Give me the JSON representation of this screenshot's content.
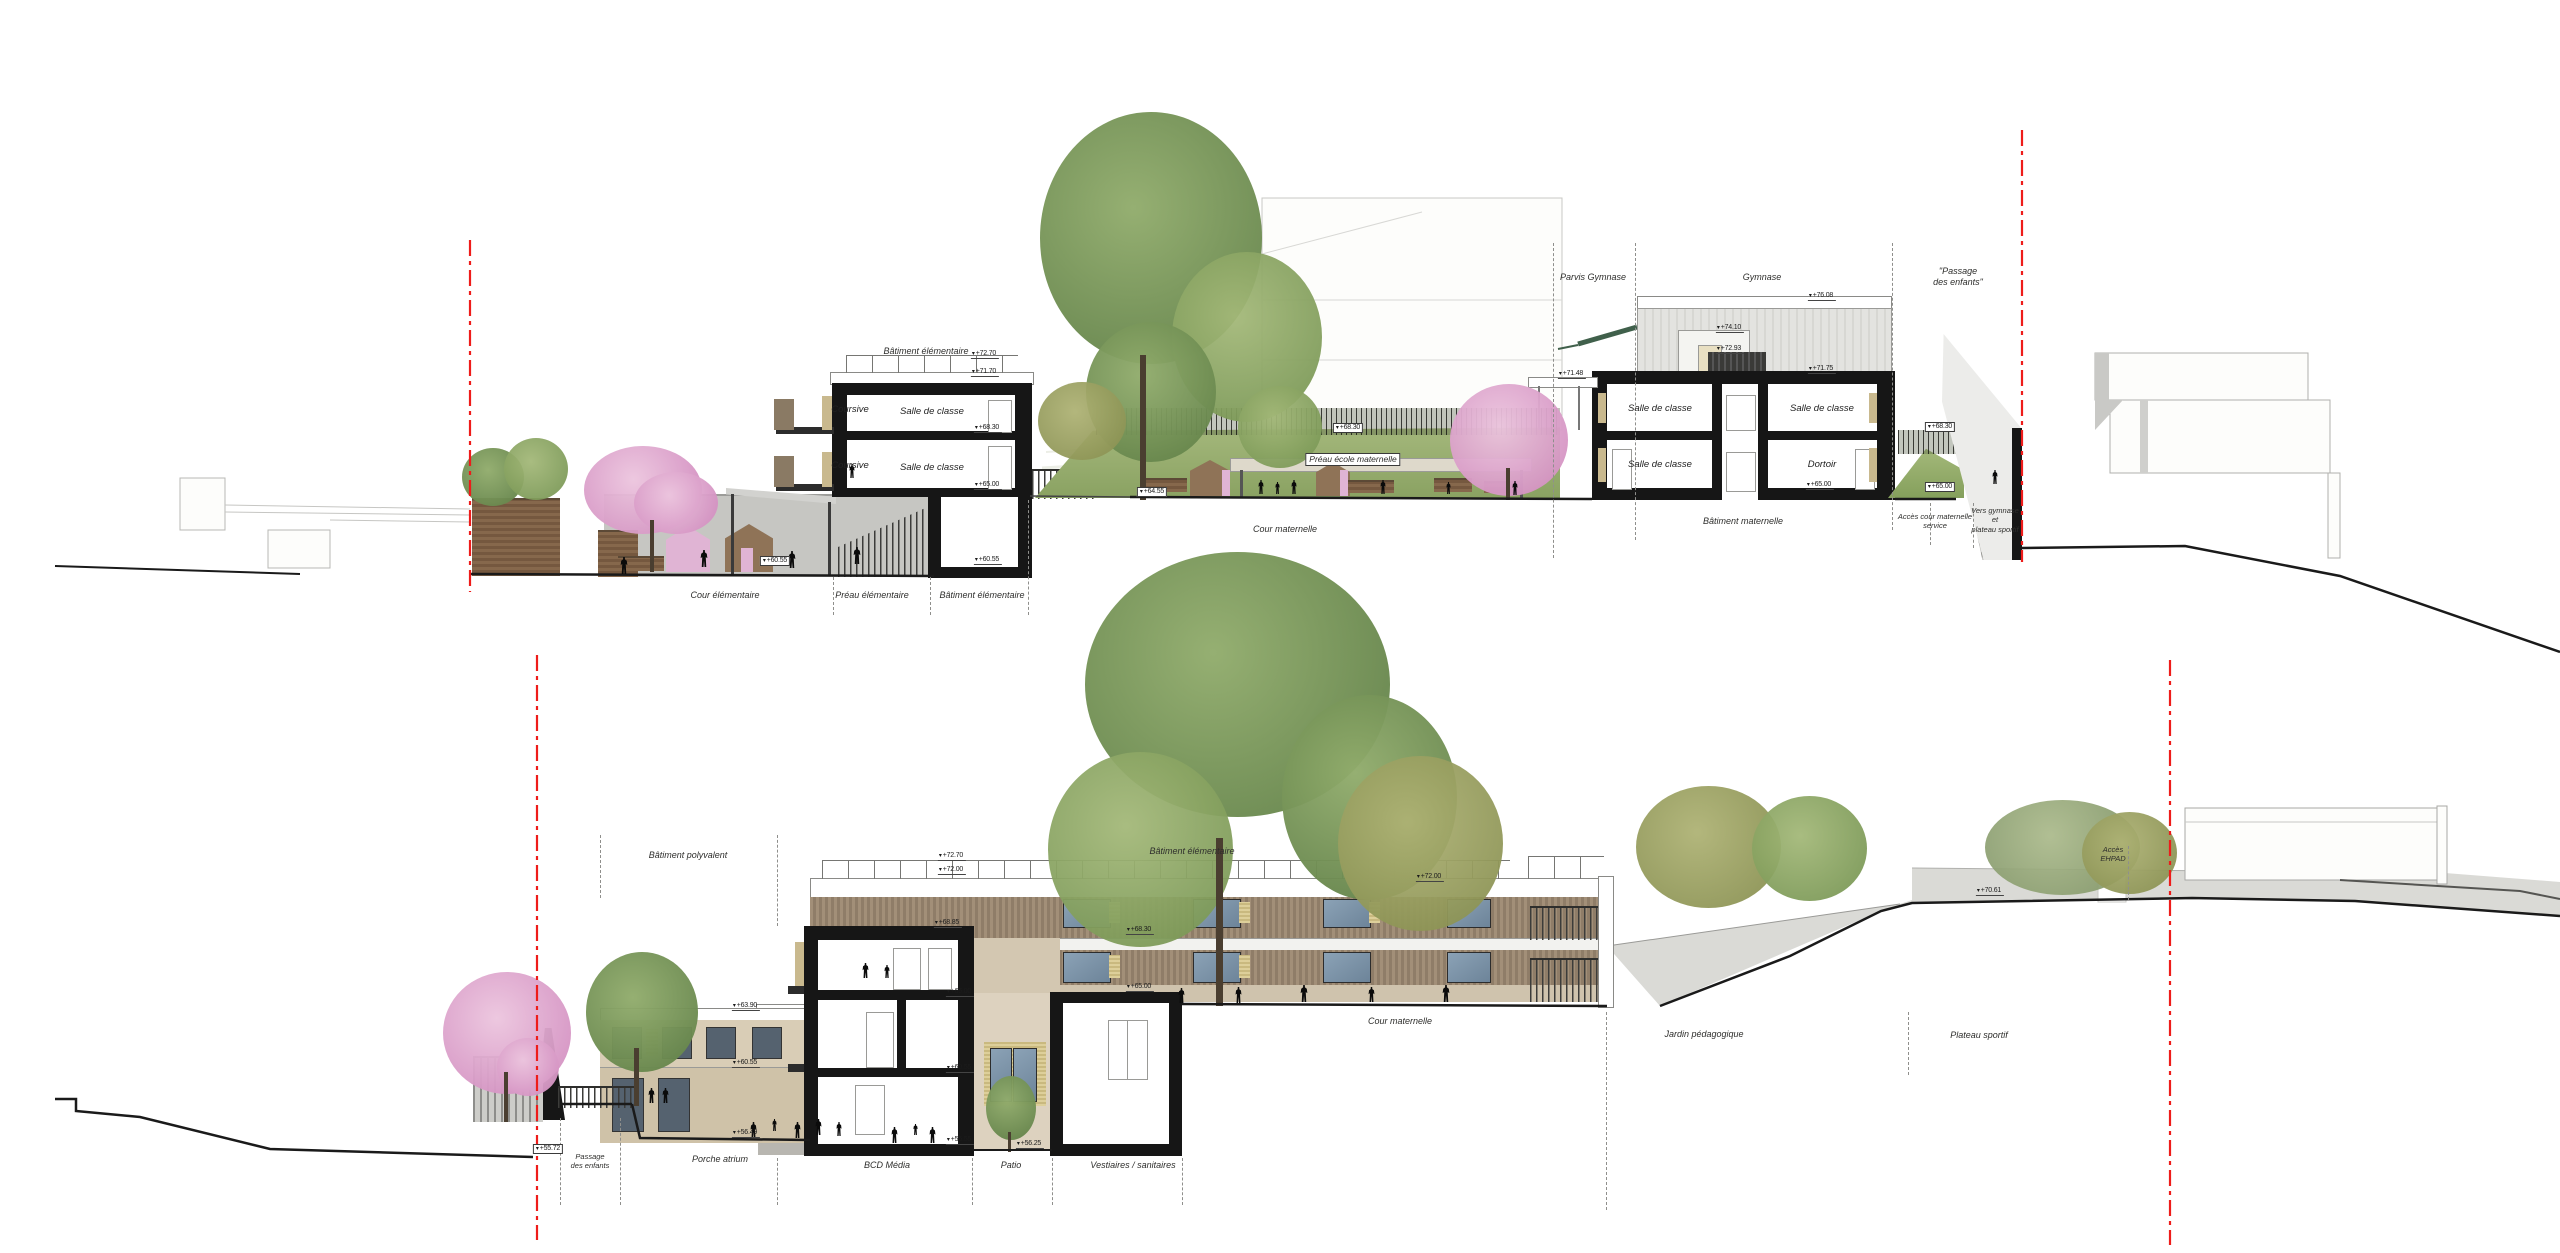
{
  "colors": {
    "cut_black": "#161616",
    "red_section_line": "#ee1c1a",
    "wood_facade": "#9b8974",
    "beige_panel": "#cfc3ad",
    "glass_blue": "#7e95aa",
    "yellow_panel": "#ddcf9a",
    "grass_green": "#9ab06d",
    "tree_green": "#7d9c5e",
    "tree_pink": "#dfa8d0",
    "concrete_gray": "#c6c6c2"
  },
  "section1": {
    "zone_labels": [
      {
        "t": "Cour élémentaire",
        "x": 725,
        "y": 590
      },
      {
        "t": "Préau élémentaire",
        "x": 872,
        "y": 590
      },
      {
        "t": "Bâtiment élémentaire",
        "x": 982,
        "y": 590
      },
      {
        "t": "Cour maternelle",
        "x": 1285,
        "y": 524
      },
      {
        "t": "Bâtiment maternelle",
        "x": 1743,
        "y": 516
      },
      {
        "t": "Accès cour maternelle\nservice",
        "x": 1935,
        "y": 512,
        "sm": 1
      },
      {
        "t": "Vers gymnase\net\nplateau sportif",
        "x": 1995,
        "y": 506,
        "sm": 1
      },
      {
        "t": "Parvis Gymnase",
        "x": 1593,
        "y": 272
      },
      {
        "t": "Gymnase",
        "x": 1762,
        "y": 272
      },
      {
        "t": "\"Passage\ndes enfants\"",
        "x": 1958,
        "y": 266
      },
      {
        "t": "Bâtiment élémentaire",
        "x": 926,
        "y": 346
      },
      {
        "t": "Préau école maternelle",
        "x": 1353,
        "y": 453,
        "boxed": 1
      }
    ],
    "room_labels": [
      {
        "t": "Coursive",
        "x": 850,
        "y": 404
      },
      {
        "t": "Coursive",
        "x": 850,
        "y": 460
      },
      {
        "t": "Salle de classe",
        "x": 932,
        "y": 406
      },
      {
        "t": "Salle de classe",
        "x": 932,
        "y": 462
      },
      {
        "t": "Salle de classe",
        "x": 1660,
        "y": 403
      },
      {
        "t": "Salle de classe",
        "x": 1822,
        "y": 403
      },
      {
        "t": "Salle de classe",
        "x": 1660,
        "y": 459
      },
      {
        "t": "Dortoir",
        "x": 1822,
        "y": 459
      }
    ],
    "elevations": [
      {
        "t": "+72.70",
        "x": 985,
        "y": 350
      },
      {
        "t": "+71.70",
        "x": 985,
        "y": 368
      },
      {
        "t": "+68.30",
        "x": 988,
        "y": 424
      },
      {
        "t": "+65.00",
        "x": 988,
        "y": 481
      },
      {
        "t": "+60.55",
        "x": 988,
        "y": 556
      },
      {
        "t": "+60.55",
        "x": 775,
        "y": 556,
        "boxed": 1
      },
      {
        "t": "+64.55",
        "x": 1152,
        "y": 487,
        "boxed": 1
      },
      {
        "t": "+68.30",
        "x": 1348,
        "y": 423,
        "boxed": 1
      },
      {
        "t": "+76.08",
        "x": 1822,
        "y": 292
      },
      {
        "t": "+74.10",
        "x": 1730,
        "y": 324
      },
      {
        "t": "+72.93",
        "x": 1730,
        "y": 345
      },
      {
        "t": "+71.75",
        "x": 1822,
        "y": 365
      },
      {
        "t": "+71.48",
        "x": 1572,
        "y": 370
      },
      {
        "t": "+68.30",
        "x": 1940,
        "y": 422,
        "boxed": 1
      },
      {
        "t": "+65.00",
        "x": 1820,
        "y": 481
      },
      {
        "t": "+65.00",
        "x": 1940,
        "y": 482,
        "boxed": 1
      }
    ],
    "separators": [
      {
        "x": 833,
        "y1": 577,
        "y2": 615
      },
      {
        "x": 930,
        "y1": 577,
        "y2": 615
      },
      {
        "x": 1028,
        "y1": 500,
        "y2": 615
      },
      {
        "x": 1553,
        "y1": 243,
        "y2": 558
      },
      {
        "x": 1635,
        "y1": 243,
        "y2": 540
      },
      {
        "x": 1892,
        "y1": 243,
        "y2": 530
      },
      {
        "x": 1930,
        "y1": 503,
        "y2": 545
      },
      {
        "x": 1973,
        "y1": 503,
        "y2": 548
      }
    ],
    "people": [
      {
        "x": 620,
        "y": 557
      },
      {
        "x": 700,
        "y": 550
      },
      {
        "x": 788,
        "y": 551
      },
      {
        "x": 853,
        "y": 547
      },
      {
        "x": 849,
        "y": 464,
        "h": 14
      },
      {
        "x": 1258,
        "y": 480,
        "h": 14
      },
      {
        "x": 1275,
        "y": 482,
        "h": 12
      },
      {
        "x": 1291,
        "y": 480,
        "h": 14
      },
      {
        "x": 1380,
        "y": 480,
        "h": 14
      },
      {
        "x": 1446,
        "y": 482,
        "h": 12
      },
      {
        "x": 1512,
        "y": 481,
        "h": 14
      },
      {
        "x": 1992,
        "y": 470,
        "h": 14
      }
    ]
  },
  "section2": {
    "zone_labels": [
      {
        "t": "Bâtiment polyvalent",
        "x": 688,
        "y": 850
      },
      {
        "t": "Bâtiment élémentaire",
        "x": 1192,
        "y": 846
      },
      {
        "t": "Passage\ndes enfants",
        "x": 590,
        "y": 1152,
        "sm": 1
      },
      {
        "t": "Porche atrium",
        "x": 720,
        "y": 1154
      },
      {
        "t": "BCD Média",
        "x": 887,
        "y": 1160
      },
      {
        "t": "Patio",
        "x": 1011,
        "y": 1160
      },
      {
        "t": "Vestiaires / sanitaires",
        "x": 1133,
        "y": 1160
      },
      {
        "t": "Cour maternelle",
        "x": 1400,
        "y": 1016
      },
      {
        "t": "Jardin pédagogique",
        "x": 1704,
        "y": 1029
      },
      {
        "t": "Plateau sportif",
        "x": 1979,
        "y": 1030
      },
      {
        "t": "Accès\nEHPAD",
        "x": 2113,
        "y": 845,
        "sm": 1
      }
    ],
    "room_labels": [],
    "elevations": [
      {
        "t": "+72.70",
        "x": 952,
        "y": 852
      },
      {
        "t": "+72.00",
        "x": 952,
        "y": 866
      },
      {
        "t": "+72.00",
        "x": 1430,
        "y": 873
      },
      {
        "t": "+68.85",
        "x": 948,
        "y": 919
      },
      {
        "t": "+68.30",
        "x": 1140,
        "y": 926
      },
      {
        "t": "+65.00",
        "x": 1140,
        "y": 983
      },
      {
        "t": "+65.00",
        "x": 960,
        "y": 988
      },
      {
        "t": "+60.55",
        "x": 960,
        "y": 1064
      },
      {
        "t": "+56.55",
        "x": 960,
        "y": 1136
      },
      {
        "t": "+56.25",
        "x": 1030,
        "y": 1140
      },
      {
        "t": "+63.90",
        "x": 746,
        "y": 1002
      },
      {
        "t": "+60.55",
        "x": 746,
        "y": 1059
      },
      {
        "t": "+56.49",
        "x": 746,
        "y": 1129
      },
      {
        "t": "+55.72",
        "x": 548,
        "y": 1144,
        "boxed": 1
      },
      {
        "t": "+70.61",
        "x": 1990,
        "y": 887
      }
    ],
    "separators": [
      {
        "x": 560,
        "y1": 1118,
        "y2": 1205
      },
      {
        "x": 620,
        "y1": 1118,
        "y2": 1205
      },
      {
        "x": 600,
        "y1": 835,
        "y2": 898
      },
      {
        "x": 777,
        "y1": 835,
        "y2": 926
      },
      {
        "x": 777,
        "y1": 1158,
        "y2": 1205
      },
      {
        "x": 972,
        "y1": 1158,
        "y2": 1205
      },
      {
        "x": 1052,
        "y1": 1158,
        "y2": 1205
      },
      {
        "x": 1182,
        "y1": 1158,
        "y2": 1205
      },
      {
        "x": 1606,
        "y1": 1012,
        "y2": 1210
      },
      {
        "x": 1908,
        "y1": 1012,
        "y2": 1075
      },
      {
        "x": 2128,
        "y1": 846,
        "y2": 900
      }
    ],
    "people": [
      {
        "x": 862,
        "y": 963,
        "h": 15
      },
      {
        "x": 884,
        "y": 965,
        "h": 13
      },
      {
        "x": 891,
        "y": 1127,
        "h": 16
      },
      {
        "x": 913,
        "y": 1124,
        "h": 11
      },
      {
        "x": 929,
        "y": 1127,
        "h": 16
      },
      {
        "x": 648,
        "y": 1088,
        "h": 15
      },
      {
        "x": 662,
        "y": 1088,
        "h": 15
      },
      {
        "x": 750,
        "y": 1122,
        "h": 16
      },
      {
        "x": 772,
        "y": 1119,
        "h": 12
      },
      {
        "x": 794,
        "y": 1122,
        "h": 16
      },
      {
        "x": 815,
        "y": 1119,
        "h": 16
      },
      {
        "x": 836,
        "y": 1122,
        "h": 14
      },
      {
        "x": 1235,
        "y": 987,
        "h": 16
      },
      {
        "x": 1300,
        "y": 985,
        "h": 17
      },
      {
        "x": 1368,
        "y": 987,
        "h": 15
      },
      {
        "x": 1442,
        "y": 985,
        "h": 17
      },
      {
        "x": 1178,
        "y": 988,
        "h": 15
      }
    ]
  }
}
